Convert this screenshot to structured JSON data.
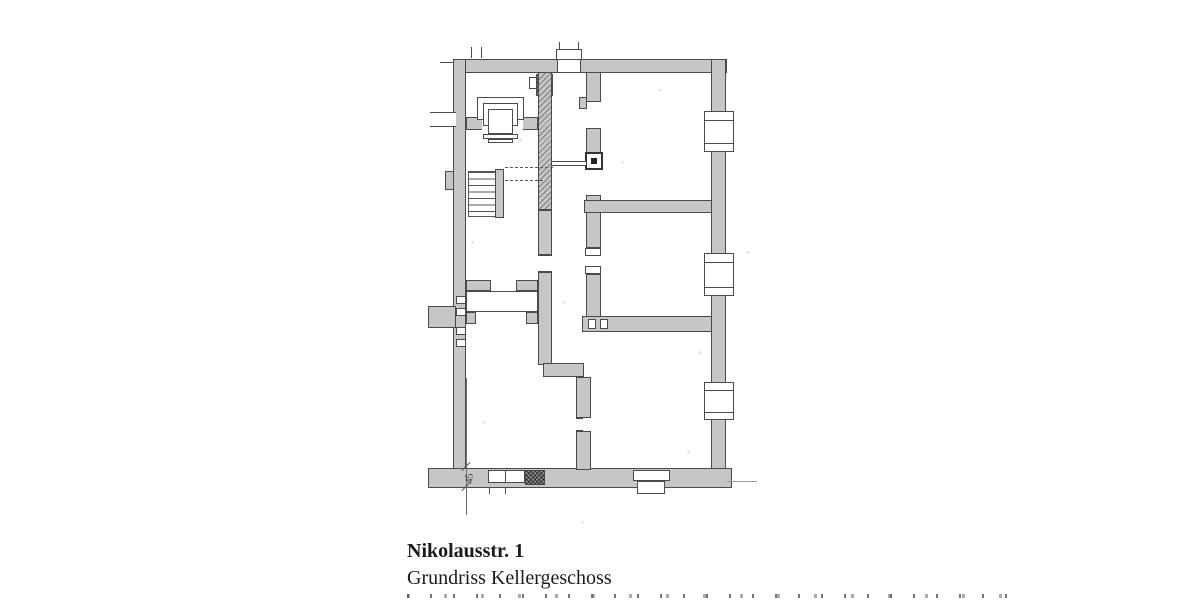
{
  "caption": {
    "title": "Nikolausstr. 1",
    "subtitle": "Grundriss Kellergeschoss"
  },
  "plan": {
    "type": "floor-plan",
    "dimension_labels": [
      "45"
    ],
    "colors": {
      "wall_fill": "#c6c6c6",
      "wall_edge": "#4a4a4a",
      "chimney_fill": "#8f8f8f",
      "paper": "#ffffff",
      "dim_line": "#6e6e6e"
    }
  }
}
